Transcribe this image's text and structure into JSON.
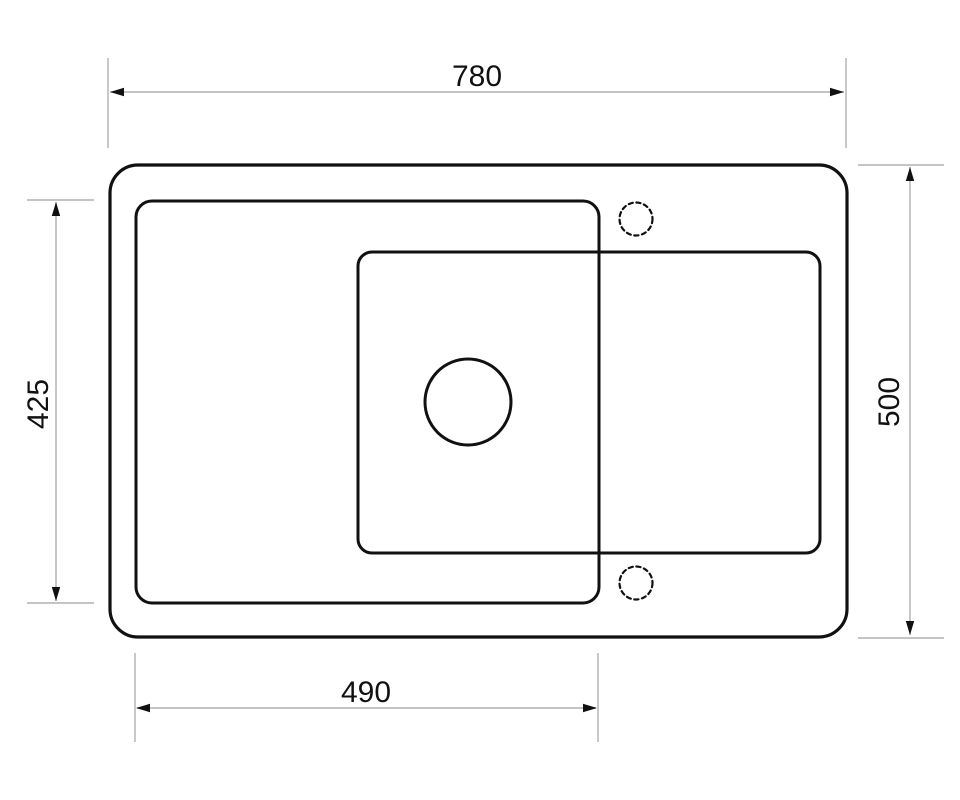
{
  "drawing": {
    "kind": "technical-dimension-drawing",
    "subject": "sink-top-view",
    "dimensions": {
      "top_width": {
        "value": "780",
        "side": "top",
        "orientation": "horizontal"
      },
      "right_height": {
        "value": "500",
        "side": "right",
        "orientation": "vertical"
      },
      "left_height": {
        "value": "425",
        "side": "left",
        "orientation": "vertical"
      },
      "bottom_width": {
        "value": "490",
        "side": "bottom",
        "orientation": "horizontal"
      }
    },
    "colors": {
      "outline": "#111111",
      "dimension_line": "#b0b0b0",
      "arrowhead": "#111111",
      "text": "#111111",
      "background": "#ffffff"
    }
  }
}
